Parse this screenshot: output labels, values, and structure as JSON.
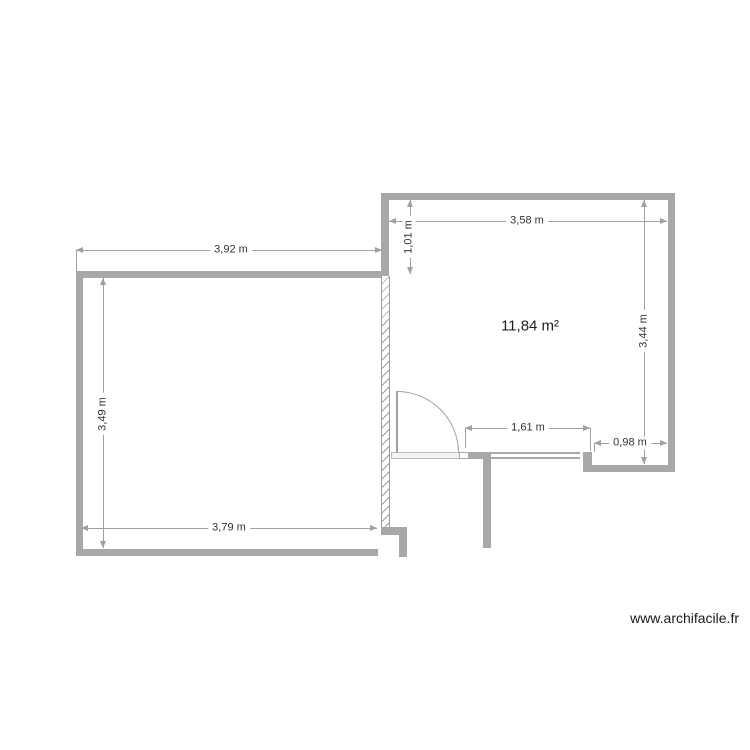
{
  "plan": {
    "rooms": {
      "right": {
        "area_label": "11,84 m²"
      }
    },
    "dimensions": {
      "left_room_top": "3,92 m",
      "left_room_left": "3,49 m",
      "left_room_bottom": "3,79 m",
      "right_room_top": "3,58 m",
      "right_room_left_upper": "1,01 m",
      "right_room_right": "3,44 m",
      "right_room_opening": "1,61 m",
      "right_room_recess": "0,98 m"
    }
  },
  "watermark": "www.archifacile.fr",
  "colors": {
    "wall": "#a8a8a8",
    "hatch": "#9e9e9e",
    "dim_line": "#a0a0a0",
    "dim_text": "#333333",
    "area_text": "#1f1f1f",
    "threshold": "#e8e8e8",
    "door": "#a0a0a0",
    "background": "#ffffff"
  }
}
